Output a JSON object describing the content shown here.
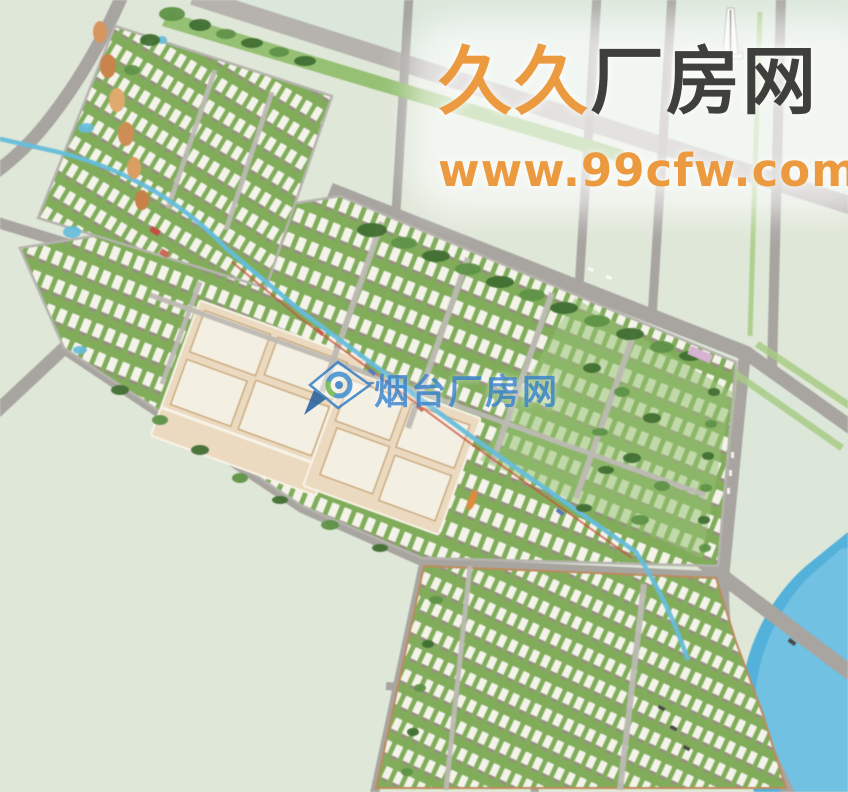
{
  "watermarks": {
    "top": {
      "brand_first": "久久",
      "brand_rest": "厂房网",
      "url": "www.99cfw.com"
    },
    "center": {
      "brand": "烟台厂房网",
      "logo": "magnifier-diamond-logo"
    }
  },
  "scene": {
    "type": "industrial-park-master-plan-rendering",
    "colors": {
      "land": "#dfe7d7",
      "land_pale": "#dbe7db",
      "road": "#a8a5a1",
      "road_light": "#b6b3ae",
      "street": "#bdb9b3",
      "water": "#4fb2dd",
      "water_light": "#8ed2ee",
      "canal": "#62bede",
      "accent_red": "#cf5038",
      "greenbelt": "#95c170",
      "greenbelt2": "#7fae58",
      "gline": "#a7cd82",
      "tree_dark": "#3f7030",
      "tree_light": "#5d9444",
      "building": "#f4f3ea",
      "building_shadow": "#96907e",
      "beige": "#ecdabf",
      "beige_roof": "#f4efe2",
      "beige_line": "#f8f4e8",
      "beige_shadow": "#c9a878",
      "curb": "#c08a5a",
      "orange": "#d9965c",
      "pink": "#d7b3d3",
      "monument": "#f8f8f3",
      "car": "#4a4a46",
      "wm_orange": "#ec9a40",
      "wm_dark": "#3f403c",
      "wm_blue": "#3d87d1"
    }
  }
}
